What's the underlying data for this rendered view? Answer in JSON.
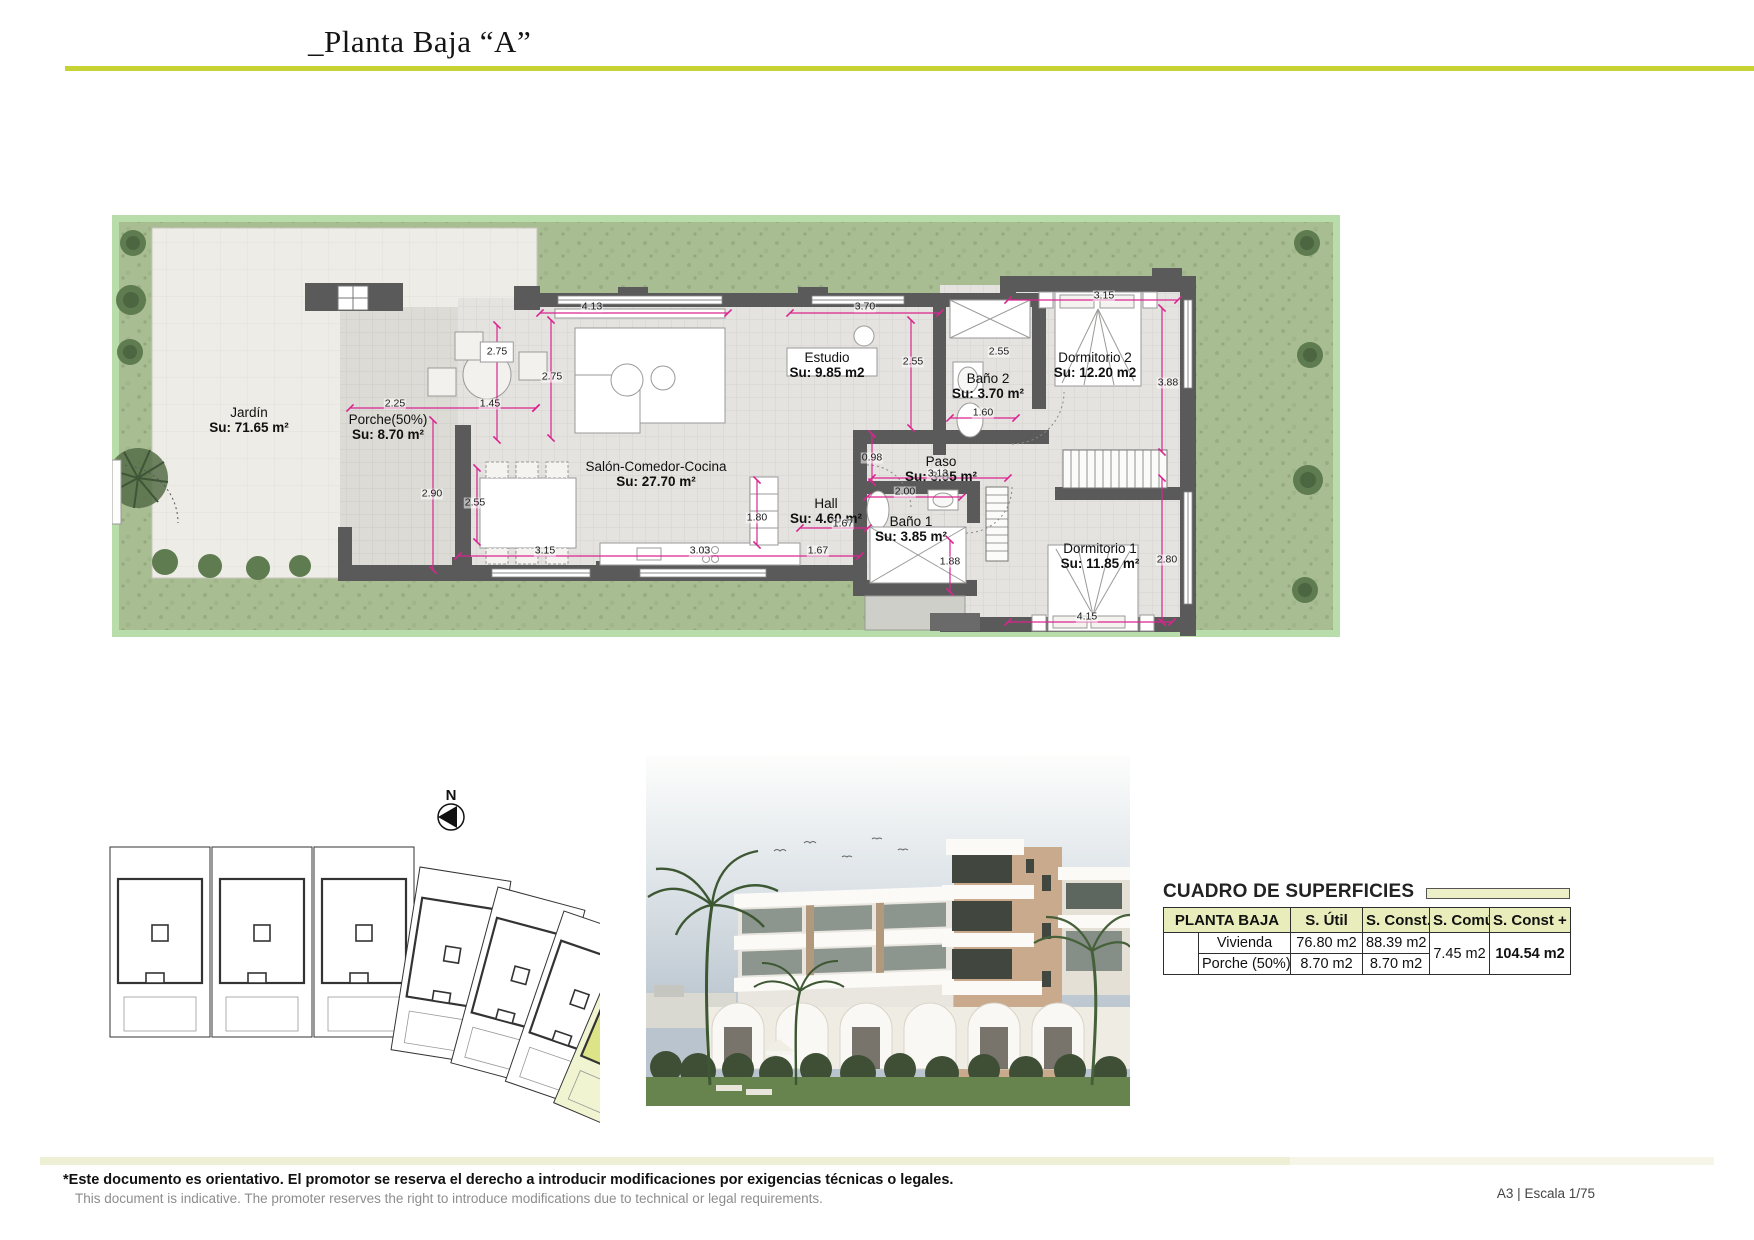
{
  "page": {
    "title": "_Planta Baja “A”",
    "scale_note": "A3 | Escala 1/75",
    "disclaimer_es": "*Este documento es orientativo. El promotor se reserva el derecho a introducir modificaciones por exigencias técnicas o legales.",
    "disclaimer_en": "This document is indicative. The promoter reserves the right to introduce modifications due to technical or legal requirements."
  },
  "colors": {
    "accent": "#c6d333",
    "dimension_pink": "#d9258f",
    "grass": "#a9bd92",
    "wall_gray": "#5a5a5a",
    "site_highlight": "#dde387",
    "table_header_bg": "#e9edbb"
  },
  "site": {
    "compass_label": "N"
  },
  "plan": {
    "rooms": [
      {
        "label": "Jardín",
        "su": "Su: 71.65 m²",
        "x": 249,
        "y": 405
      },
      {
        "label": "Porche(50%)",
        "su": "Su: 8.70 m²",
        "x": 388,
        "y": 412
      },
      {
        "label": "Salón-Comedor-Cocina",
        "su": "Su: 27.70 m²",
        "x": 656,
        "y": 459
      },
      {
        "label": "Estudio",
        "su": "Su: 9.85 m2",
        "x": 827,
        "y": 350
      },
      {
        "label": "Baño 2",
        "su": "Su: 3.70 m²",
        "x": 988,
        "y": 371
      },
      {
        "label": "Dormitorio 2",
        "su": "Su: 12.20 m2",
        "x": 1095,
        "y": 350
      },
      {
        "label": "Paso",
        "su": "Su: 3.05 m²",
        "x": 941,
        "y": 454
      },
      {
        "label": "Hall",
        "su": "Su: 4.60 m²",
        "x": 826,
        "y": 496
      },
      {
        "label": "Baño 1",
        "su": "Su: 3.85 m²",
        "x": 911,
        "y": 514
      },
      {
        "label": "Dormitorio 1",
        "su": "Su: 11.85 m²",
        "x": 1100,
        "y": 541
      }
    ],
    "dims": [
      {
        "v": "4.13",
        "x": 592,
        "y": 307
      },
      {
        "v": "3.70",
        "x": 865,
        "y": 307
      },
      {
        "v": "2.75",
        "x": 497,
        "y": 352,
        "boxed": true
      },
      {
        "v": "2.75",
        "x": 552,
        "y": 377
      },
      {
        "v": "2.55",
        "x": 913,
        "y": 362
      },
      {
        "v": "2.55",
        "x": 999,
        "y": 352
      },
      {
        "v": "1.60",
        "x": 983,
        "y": 413
      },
      {
        "v": "3.15",
        "x": 1104,
        "y": 296
      },
      {
        "v": "3.88",
        "x": 1168,
        "y": 383
      },
      {
        "v": "2.25",
        "x": 395,
        "y": 404
      },
      {
        "v": "1.45",
        "x": 490,
        "y": 404
      },
      {
        "v": "2.90",
        "x": 432,
        "y": 494
      },
      {
        "v": "2.55",
        "x": 475,
        "y": 503
      },
      {
        "v": "0.98",
        "x": 872,
        "y": 458
      },
      {
        "v": "3.13",
        "x": 938,
        "y": 474
      },
      {
        "v": "2.00",
        "x": 905,
        "y": 492
      },
      {
        "v": "1.80",
        "x": 757,
        "y": 518
      },
      {
        "v": "1.67",
        "x": 843,
        "y": 524
      },
      {
        "v": "3.15",
        "x": 545,
        "y": 551
      },
      {
        "v": "3.03",
        "x": 700,
        "y": 551
      },
      {
        "v": "1.67",
        "x": 818,
        "y": 551
      },
      {
        "v": "1.88",
        "x": 950,
        "y": 562
      },
      {
        "v": "2.80",
        "x": 1167,
        "y": 560
      },
      {
        "v": "4.15",
        "x": 1087,
        "y": 617
      }
    ]
  },
  "table": {
    "title": "CUADRO DE SUPERFICIES",
    "col_headers": [
      "PLANTA BAJA",
      "S. Útil",
      "S. Const.",
      "S. Común",
      "S. Const + S.C"
    ],
    "rows": [
      [
        "Vivienda",
        "76.80 m2",
        "88.39 m2"
      ],
      [
        "Porche (50%)",
        "8.70 m2",
        "8.70 m2"
      ]
    ],
    "s_comun": "7.45 m2",
    "total": "104.54 m2"
  }
}
